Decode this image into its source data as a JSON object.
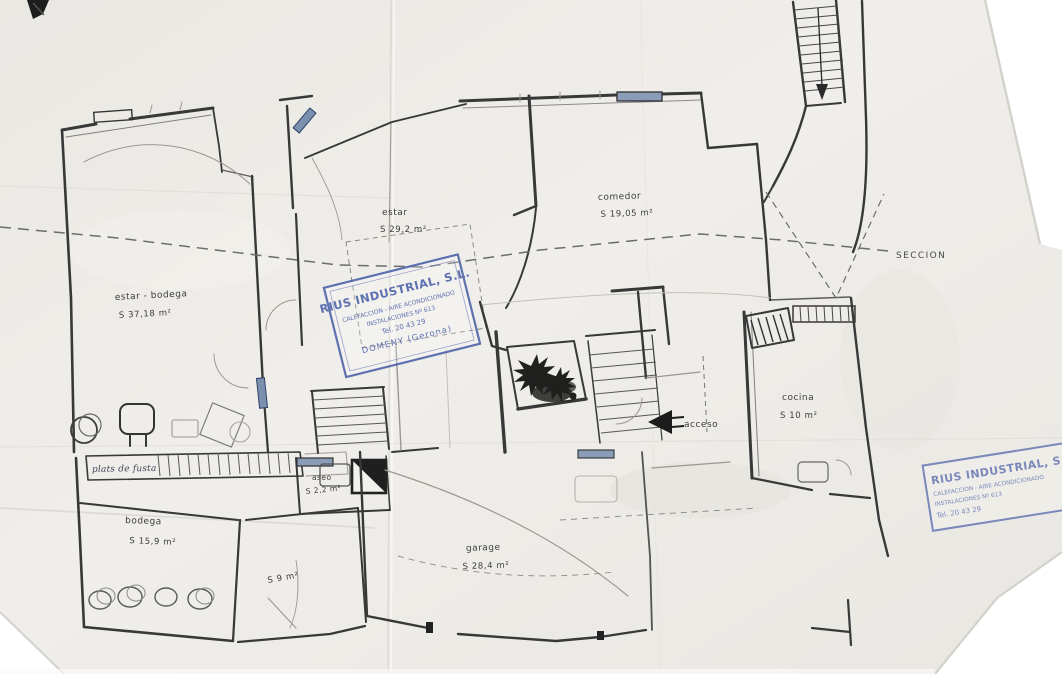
{
  "document": {
    "kind": "hand-drawn floor plan scan"
  },
  "rooms": {
    "estar_bodega": {
      "label": "estar - bodega",
      "area": "S 37,18 m²"
    },
    "estar": {
      "label": "estar",
      "area": "S 29,2 m²"
    },
    "comedor": {
      "label": "comedor",
      "area": "S 19,05 m²"
    },
    "cocina": {
      "label": "cocina",
      "area": "S 10 m²"
    },
    "aseo": {
      "label": "aseo",
      "area": "S 2,2 m²"
    },
    "bodega": {
      "label": "bodega",
      "area": "S 15,9 m²"
    },
    "storeroom": {
      "area": "S 9 m²"
    },
    "garage": {
      "label": "garage",
      "area": "S 28,4 m²"
    }
  },
  "annotations": {
    "acceso": "acceso",
    "seccion": "SECCION",
    "handwritten_note": "plats de fusta"
  },
  "stamp": {
    "company": "RIUS INDUSTRIAL, S.L.",
    "line2": "CALEFACCION - AIRE ACONDICIONADO",
    "line3": "INSTALACIONES Nº 613",
    "line4": "Tel. 20 43 29",
    "line5": "DOMENY (Gerona)"
  },
  "colors": {
    "ink": "#383838",
    "stamp_blue": "#4a5fa8",
    "paper": "#edebe6"
  }
}
